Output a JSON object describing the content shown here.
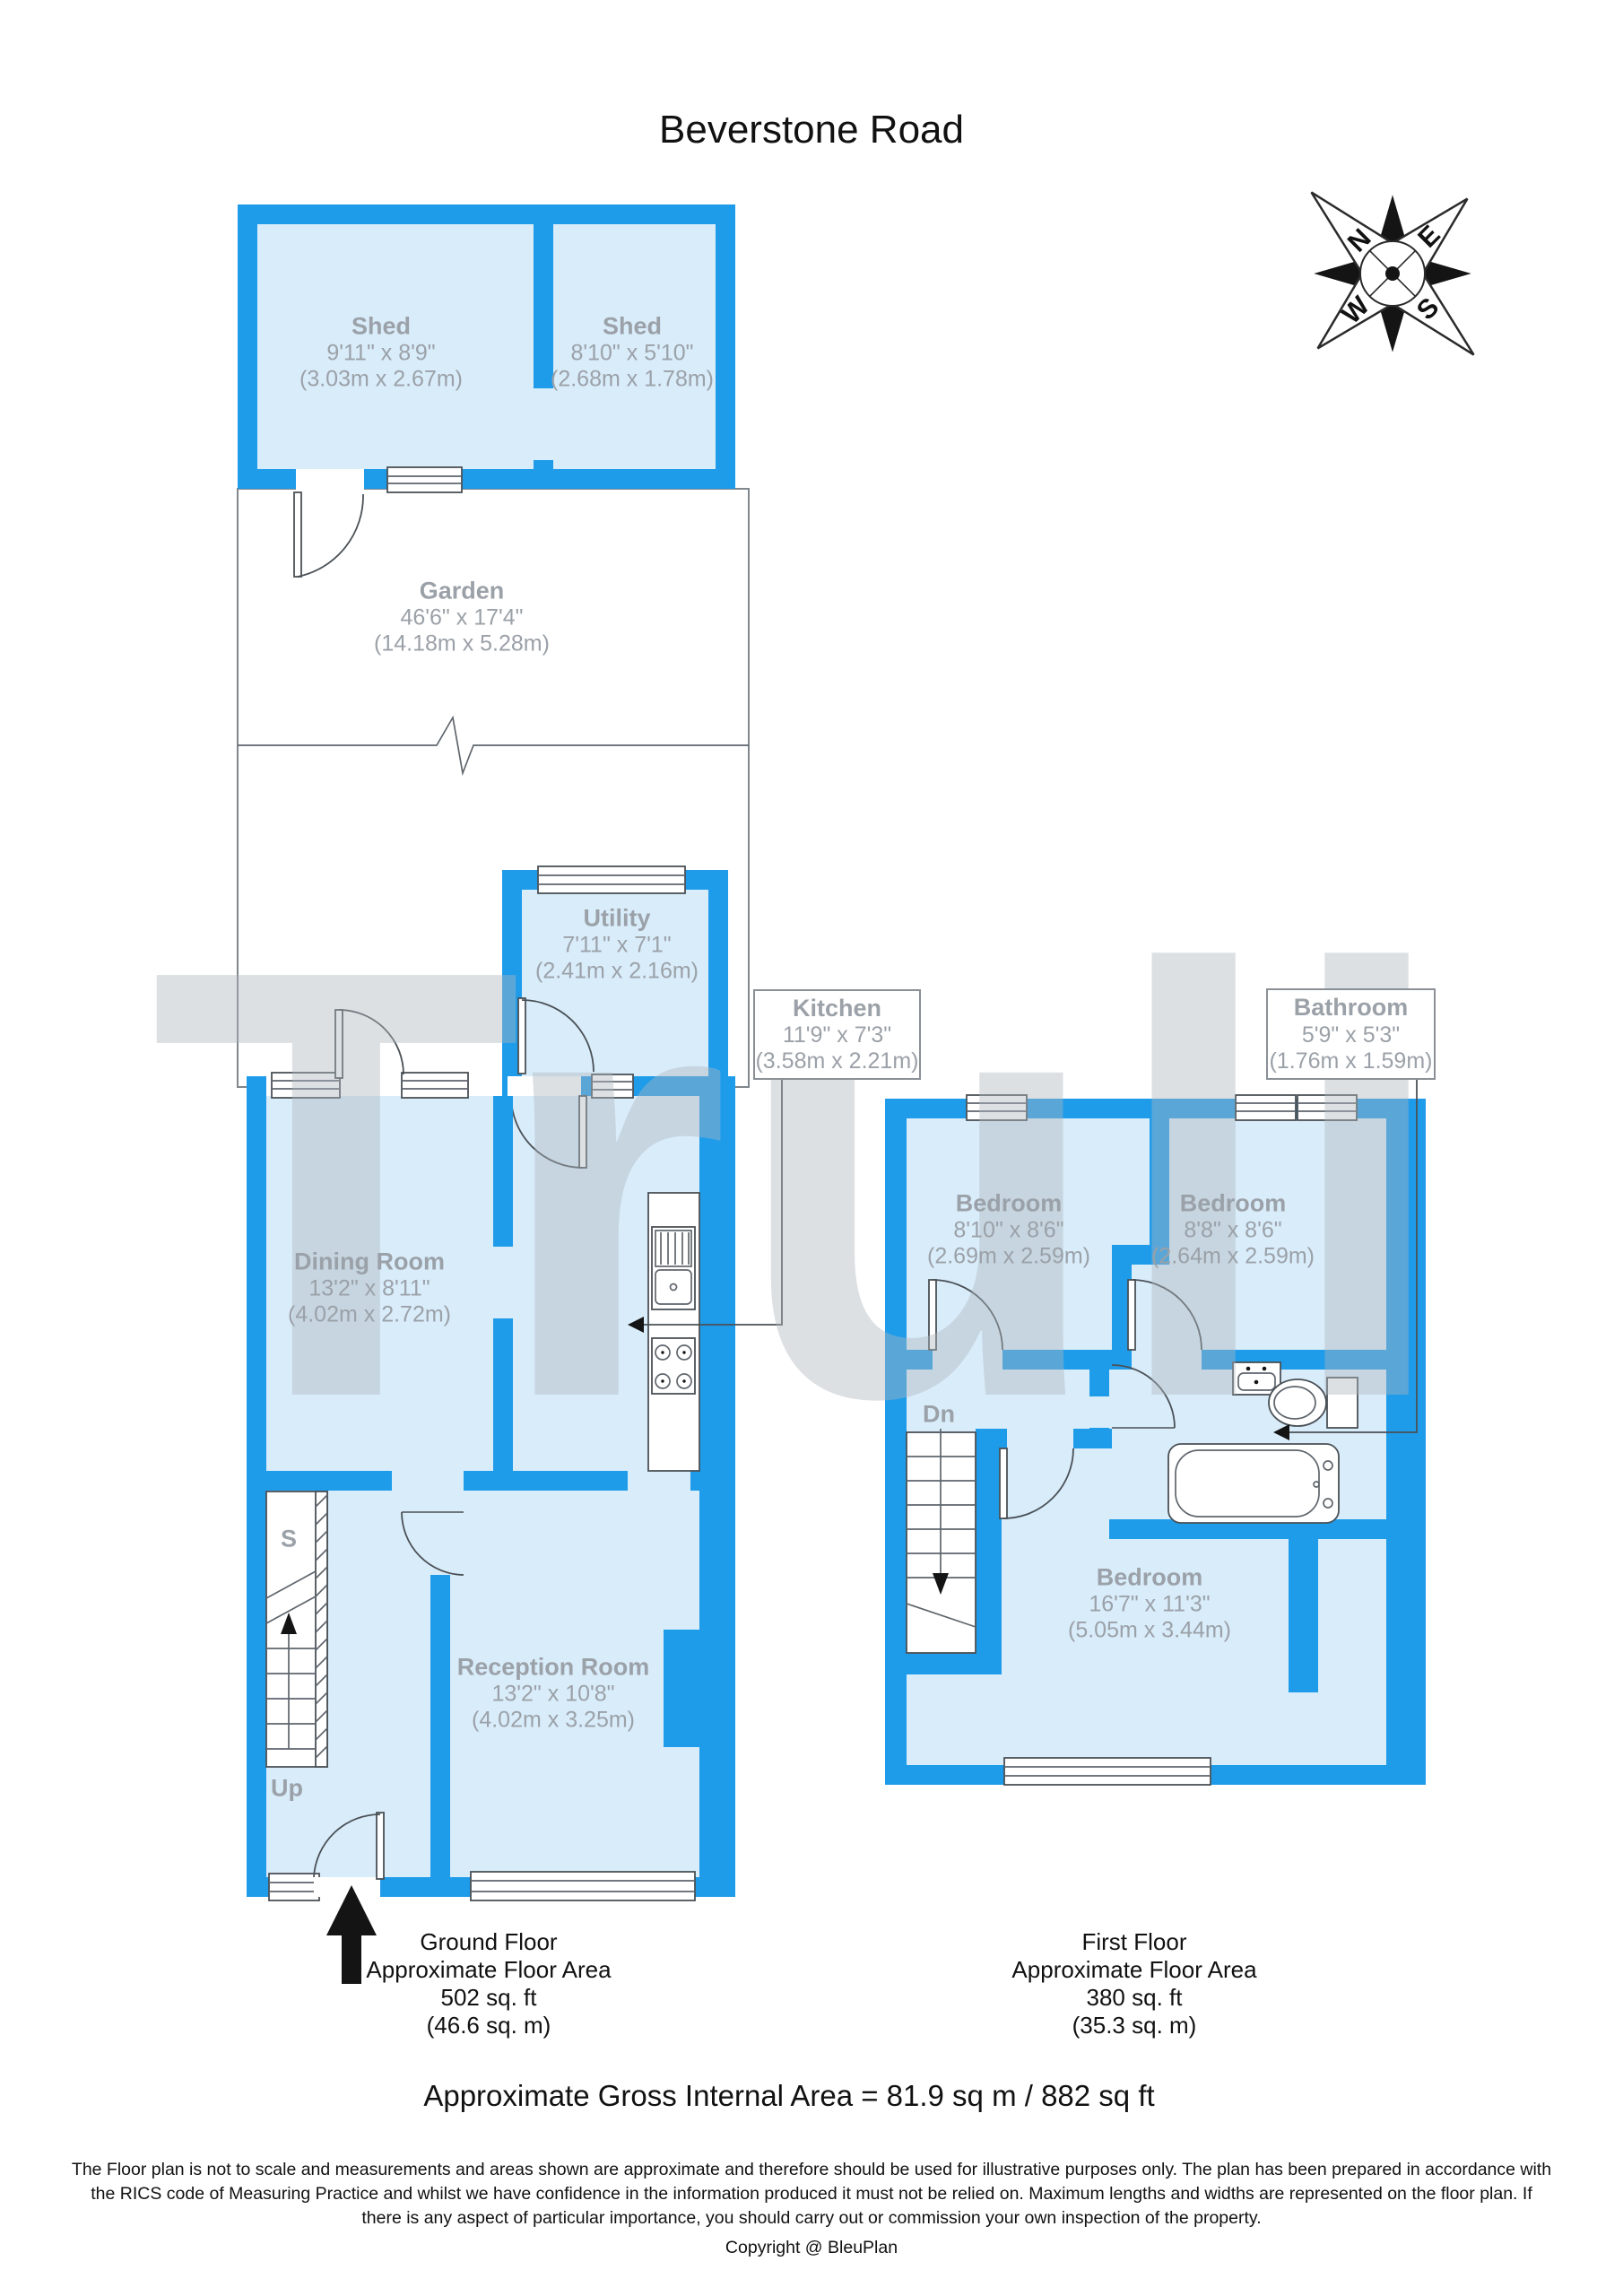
{
  "title": "Beverstone Road",
  "watermark": "Truli",
  "compass": {
    "n": "N",
    "e": "E",
    "s": "S",
    "w": "W"
  },
  "colors": {
    "wall_blue": "#1E9CEA",
    "room_fill": "#D9ECFA",
    "label_gray": "#9BA1A8",
    "line_gray": "#4A5156",
    "watermark_gray": "#AEB6BE"
  },
  "rooms": {
    "shed1": {
      "name": "Shed",
      "size_ft": "9'11\" x 8'9\"",
      "size_m": "(3.03m x 2.67m)"
    },
    "shed2": {
      "name": "Shed",
      "size_ft": "8'10\" x 5'10\"",
      "size_m": "(2.68m x 1.78m)"
    },
    "garden": {
      "name": "Garden",
      "size_ft": "46'6\" x 17'4\"",
      "size_m": "(14.18m x 5.28m)"
    },
    "utility": {
      "name": "Utility",
      "size_ft": "7'11\" x 7'1\"",
      "size_m": "(2.41m x 2.16m)"
    },
    "kitchen": {
      "name": "Kitchen",
      "size_ft": "11'9\" x 7'3\"",
      "size_m": "(3.58m x 2.21m)"
    },
    "dining": {
      "name": "Dining Room",
      "size_ft": "13'2\" x 8'11\"",
      "size_m": "(4.02m x 2.72m)"
    },
    "reception": {
      "name": "Reception Room",
      "size_ft": "13'2\" x 10'8\"",
      "size_m": "(4.02m x 3.25m)"
    },
    "bathroom": {
      "name": "Bathroom",
      "size_ft": "5'9\" x 5'3\"",
      "size_m": "(1.76m x 1.59m)"
    },
    "bedroom1": {
      "name": "Bedroom",
      "size_ft": "8'10\" x 8'6\"",
      "size_m": "(2.69m x 2.59m)"
    },
    "bedroom2": {
      "name": "Bedroom",
      "size_ft": "8'8\" x 8'6\"",
      "size_m": "(2.64m x 2.59m)"
    },
    "bedroom3": {
      "name": "Bedroom",
      "size_ft": "16'7\" x 11'3\"",
      "size_m": "(5.05m x 3.44m)"
    }
  },
  "stair_labels": {
    "storage": "S",
    "up": "Up",
    "down": "Dn"
  },
  "floor_captions": {
    "ground": [
      "Ground Floor",
      "Approximate Floor Area",
      "502 sq. ft",
      "(46.6 sq. m)"
    ],
    "first": [
      "First Floor",
      "Approximate Floor Area",
      "380 sq. ft",
      "(35.3 sq. m)"
    ]
  },
  "gross_area": "Approximate Gross Internal Area = 81.9 sq m / 882 sq ft",
  "disclaimer": [
    "The Floor plan is not to scale and measurements and areas shown are approximate and therefore should be used for illustrative purposes only. The plan has been prepared in accordance with",
    "the RICS code of Measuring Practice and whilst we have confidence in the information produced it must not be relied on. Maximum lengths and widths are represented on the floor plan. If",
    "there is any aspect of particular importance, you should carry out or commission your own inspection of the property."
  ],
  "copyright": "Copyright @ BleuPlan"
}
